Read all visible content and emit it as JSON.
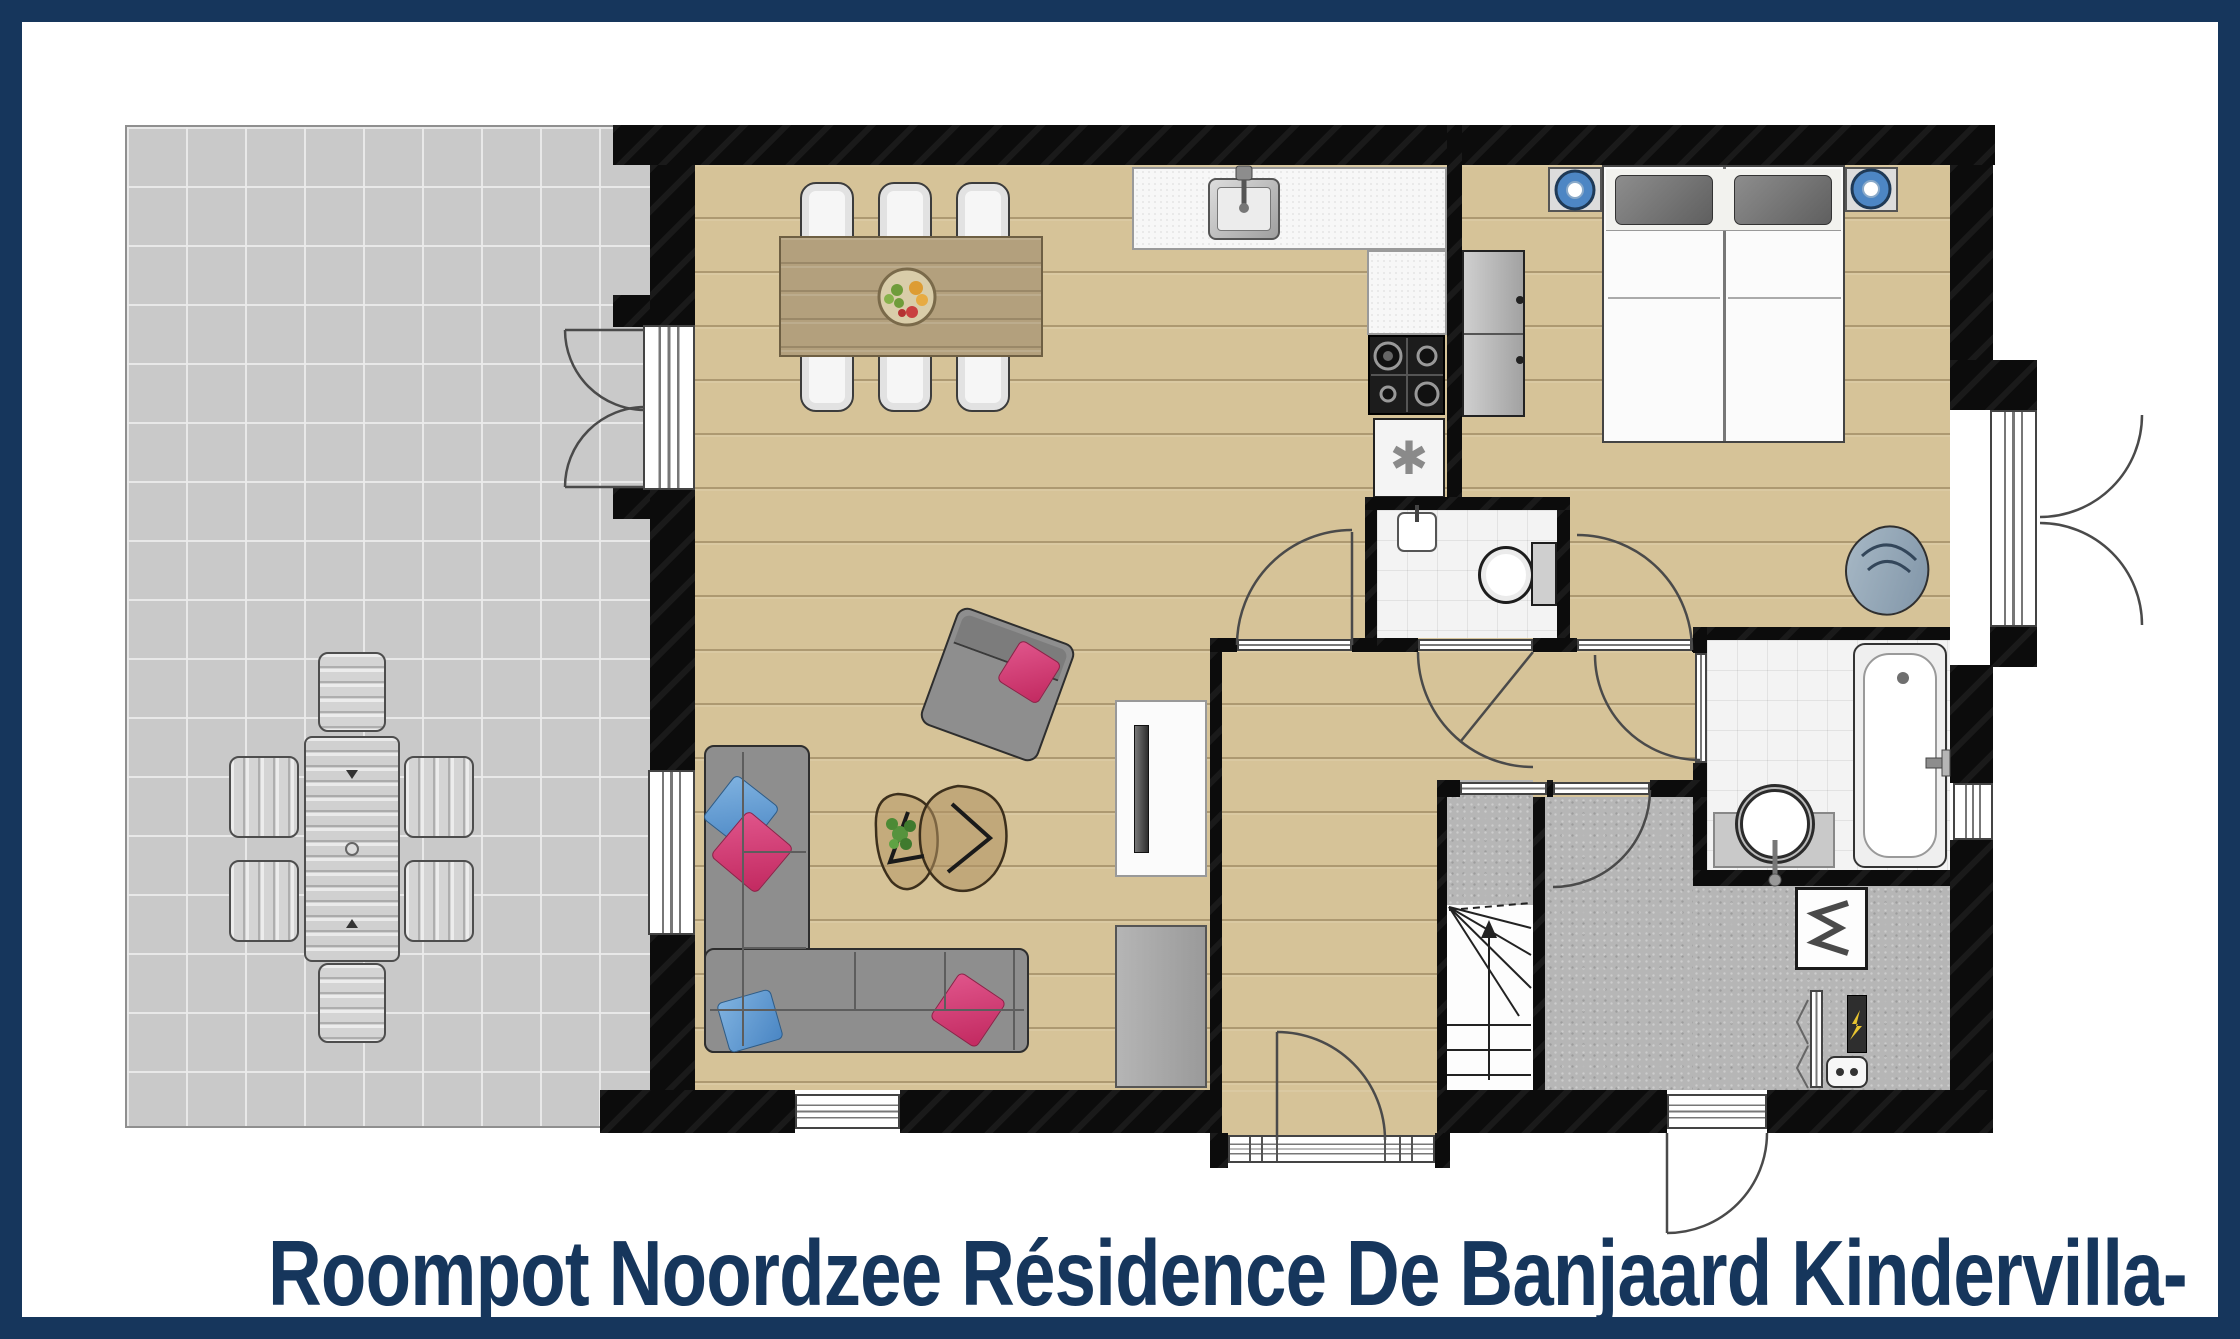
{
  "title": {
    "text": "Roompot Noordzee Résidence De Banjaard Kindervilla-"
  },
  "icons": {
    "freezer_symbol": "✱",
    "freezer_symbol_name": "freezer-asterisk-icon"
  },
  "palette": {
    "frame_navy": "#16365c",
    "title_navy": "#16365c",
    "wall_black": "#0c0c0c",
    "wood_floor": "#d6c398",
    "terrace_gray": "#c9c9c9",
    "utility_gray": "#b6b6b6",
    "tile_white": "#f3f3f3",
    "sofa_gray": "#8e8e8e",
    "pillow_pink": "#c22960",
    "pillow_blue": "#4a86c4",
    "lamp_blue": "#4d86c4",
    "plant_green": "#56933d"
  },
  "floorplan": {
    "rooms": [
      {
        "name": "terrace"
      },
      {
        "name": "living-dining-room"
      },
      {
        "name": "kitchen"
      },
      {
        "name": "bedroom"
      },
      {
        "name": "wc"
      },
      {
        "name": "bathroom"
      },
      {
        "name": "hallway"
      },
      {
        "name": "entrance-hall"
      },
      {
        "name": "staircase"
      },
      {
        "name": "utility-room"
      },
      {
        "name": "meter-closet"
      }
    ],
    "furniture": [
      "terrace-table",
      "terrace-chairs-x6",
      "dining-table",
      "dining-chairs-x6",
      "fruit-bowl",
      "kitchen-sink",
      "gas-hob",
      "freezer-cabinet",
      "kitchen-counter",
      "corner-sofa",
      "armchair",
      "coffee-tables",
      "plant",
      "tv-cabinet",
      "sideboard",
      "twin-beds",
      "nightstands-with-blue-lamps",
      "wardrobe",
      "baby-chair",
      "wc-toilet",
      "wc-hand-basin",
      "bathtub",
      "round-washbasin",
      "boiler",
      "meter-strip",
      "small-appliance",
      "winder-stairs"
    ],
    "doors": [
      "terrace-french-doors",
      "bay-french-doors",
      "living-room-door",
      "wc-door",
      "bedroom-door",
      "bathroom-door",
      "utility-door",
      "front-door",
      "back-door",
      "meter-bifold-door"
    ]
  }
}
